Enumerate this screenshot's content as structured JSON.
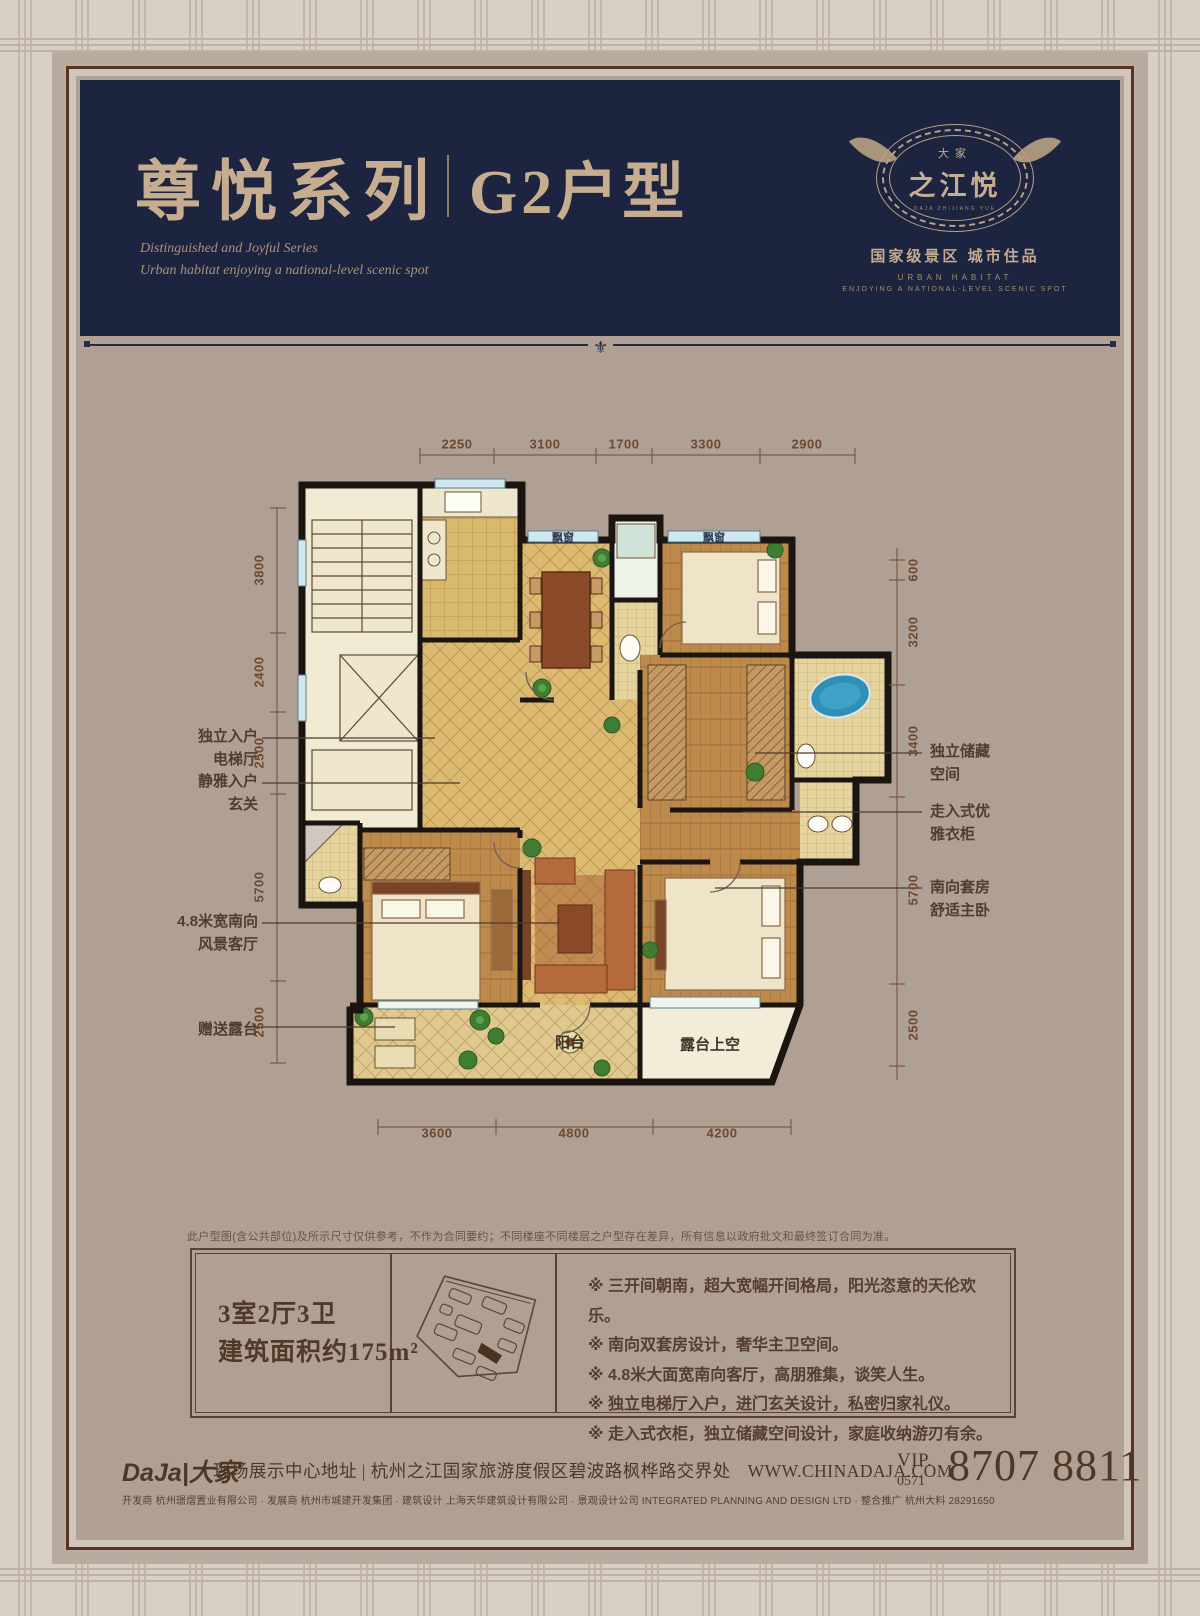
{
  "header": {
    "title_cn": "尊悦系列",
    "title_unit": "G2户型",
    "subtitle_en_1": "Distinguished and Joyful Series",
    "subtitle_en_2": "Urban habitat enjoying a national-level scenic spot",
    "ornament": "⚜",
    "logo": {
      "brand_small": "大家",
      "brand_main": "之江悦",
      "brand_sub": "DAJA ZHIJIANG YUE",
      "tagline_cn": "国家级景区  城市住品",
      "tagline_en_1": "URBAN HABITAT",
      "tagline_en_2": "ENJOYING A NATIONAL-LEVEL SCENIC SPOT"
    }
  },
  "plan": {
    "dims_top": [
      "2250",
      "3100",
      "1700",
      "3300",
      "2900"
    ],
    "dims_left": [
      "3800",
      "2400",
      "2500",
      "5700",
      "2500"
    ],
    "dims_right": [
      "600",
      "3200",
      "3400",
      "5700",
      "2500"
    ],
    "dims_bottom": [
      "3600",
      "4800",
      "4200"
    ],
    "room_labels": {
      "bay1": "飘窗",
      "bay2": "飘窗",
      "balcony": "阳台",
      "terrace": "露台上空"
    },
    "callouts_left": [
      {
        "label": "独立入户\n电梯厅"
      },
      {
        "label": "静雅入户\n玄关"
      },
      {
        "label": "4.8米宽南向\n风景客厅"
      },
      {
        "label": "赠送露台"
      }
    ],
    "callouts_right": [
      {
        "label": "独立储藏\n空间"
      },
      {
        "label": "走入式优\n雅衣柜"
      },
      {
        "label": "南向套房\n舒适主卧"
      }
    ]
  },
  "disclaimer": "此户型图(含公共部位)及所示尺寸仅供参考，不作为合同要约；不同楼座不同楼层之户型存在差异，所有信息以政府批文和最终签订合同为准。",
  "specs": {
    "line1": "3室2厅3卫",
    "line2": "建筑面积约175m²"
  },
  "features": [
    "※ 三开间朝南，超大宽幅开间格局，阳光恣意的天伦欢乐。",
    "※ 南向双套房设计，奢华主卫空间。",
    "※ 4.8米大面宽南向客厅，高朋雅集，谈笑人生。",
    "※ 独立电梯厅入户，进门玄关设计，私密归家礼仪。",
    "※ 走入式衣柜，独立储藏空间设计，家庭收纳游刃有余。"
  ],
  "footer": {
    "logo": "DaJa|大家",
    "address": "现场展示中心地址 | 杭州之江国家旅游度假区碧波路枫桦路交界处",
    "website": "WWW.CHINADAJA.COM",
    "vip_label": "VIP.",
    "vip_area": "0571",
    "phone": "8707 8811",
    "credits": "开发商 杭州璟熠置业有限公司 · 发展商 杭州市城建开发集团 · 建筑设计 上海天华建筑设计有限公司 · 景观设计公司 INTEGRATED PLANNING AND DESIGN LTD · 整合推广 杭州大料 28291650"
  },
  "colors": {
    "navy": "#1d2440",
    "gold_text": "#c6ad90",
    "panel": "#b0a094",
    "dark_brown": "#53402f",
    "bay_blue": "#cfe7f0",
    "tub_blue": "#2f8fb4"
  }
}
